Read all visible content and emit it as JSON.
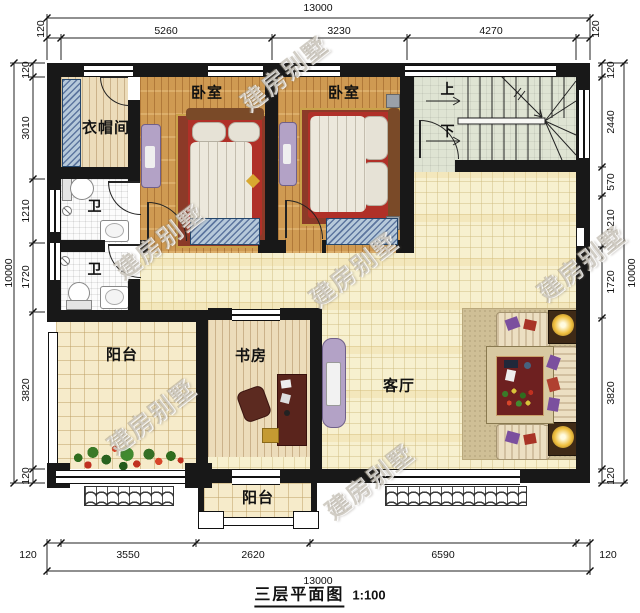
{
  "title": {
    "name": "三层平面图",
    "scale": "1:100"
  },
  "watermark": {
    "text": "建房别墅"
  },
  "rooms": {
    "cloakroom": "衣帽间",
    "bedroom_left": "卧室",
    "bedroom_right": "卧室",
    "bath_upper": "卫",
    "bath_lower": "卫",
    "study": "书房",
    "living": "客厅",
    "balcony_left": "阳台",
    "balcony_bottom": "阳台",
    "stairs_up": "上",
    "stairs_down": "下"
  },
  "dimensions": {
    "top": {
      "total": "13000",
      "segments": [
        "120",
        "5260",
        "3230",
        "4270",
        "120"
      ]
    },
    "bottom": {
      "total": "13000",
      "segments": [
        "120",
        "3550",
        "2620",
        "6590",
        "120"
      ]
    },
    "left": {
      "total": "10000",
      "segments": [
        "120",
        "3010",
        "1210",
        "1720",
        "3820",
        "120"
      ]
    },
    "right": {
      "total": "10000",
      "segments": [
        "120",
        "2440",
        "570",
        "1210",
        "1720",
        "3820",
        "120"
      ]
    }
  },
  "colors": {
    "wall": "#181818",
    "hall_tile": "#f7f0cf",
    "bedroom_wood": "#cf9a52",
    "pale_wood": "#ecdcba",
    "stair_floor": "#dfe4d3",
    "balcony_tile": "#f6ebca",
    "window_blue": "#b6c9da",
    "bed_red": "#b03028",
    "rug_red": "#8c3a28",
    "dresser_purple": "#b3a2c6",
    "sofa_cream": "#ecdfc2",
    "lamp_glow": "#f0c040"
  }
}
